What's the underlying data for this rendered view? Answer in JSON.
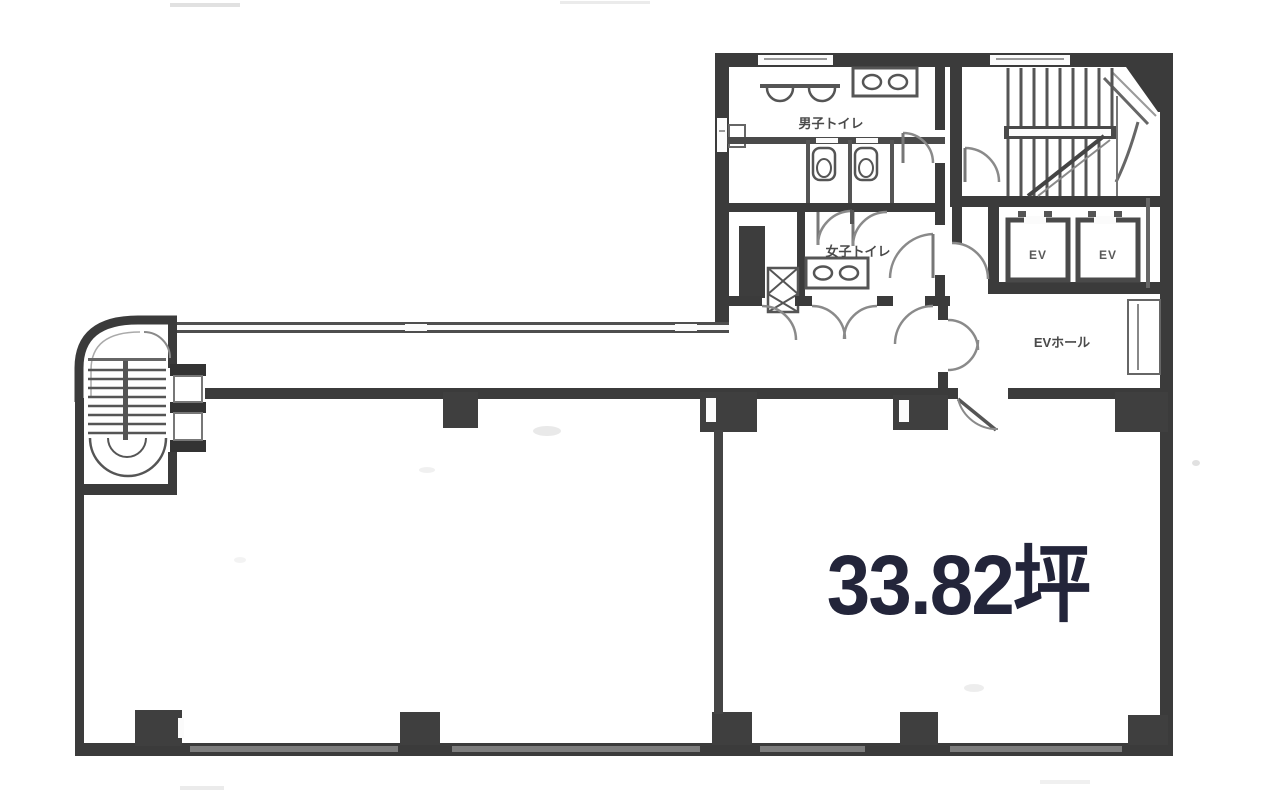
{
  "floorplan": {
    "labels": {
      "mens_toilet": "男子トイレ",
      "womens_toilet": "女子トイレ",
      "elevator_1": "EV",
      "elevator_2": "EV",
      "elevator_hall": "EVホール",
      "area": "33.82坪"
    },
    "colors": {
      "wall_dark": "#3b3b3b",
      "wall_medium": "#555555",
      "line_light": "#8a8a8a",
      "area_text": "#23253a",
      "room_label_text": "#4a4a4a",
      "background": "#ffffff"
    }
  }
}
